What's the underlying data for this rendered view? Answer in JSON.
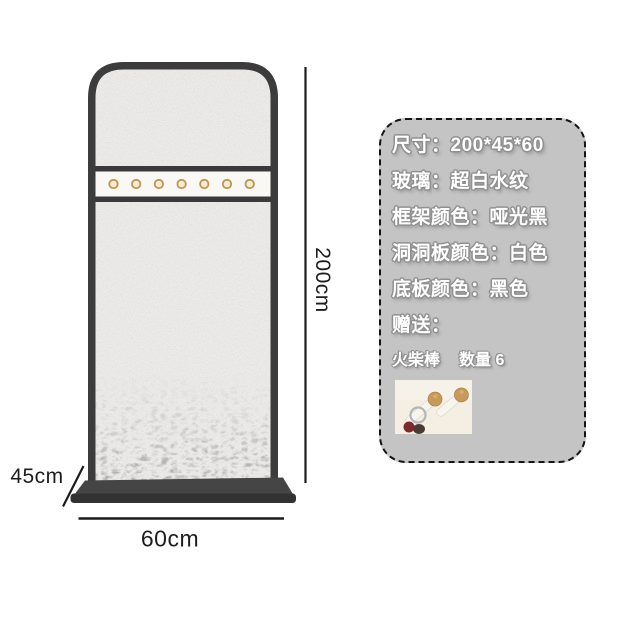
{
  "diagram": {
    "height_label": "200cm",
    "width_label": "60cm",
    "depth_label": "45cm",
    "peg_count": 7
  },
  "spec_panel": {
    "rows": [
      "尺寸：200*45*60",
      "玻璃：超白水纹",
      "框架颜色：哑光黑",
      "洞洞板颜色：白色",
      "底板颜色：黑色",
      "赠送："
    ],
    "gift_item": "火柴棒",
    "gift_quantity": "数量 6"
  },
  "colors": {
    "frame": "#3c3c3c",
    "base": "#3a3a3a",
    "glass": "#edecea",
    "pegboard_strip": "#f9f8f4",
    "peg_gold": "#bf9551",
    "panel_background": "#c4c4c4",
    "panel_text": "#ffffff",
    "panel_text_outline": "#8f8f8f",
    "dimension_text": "#1d1d1d"
  }
}
